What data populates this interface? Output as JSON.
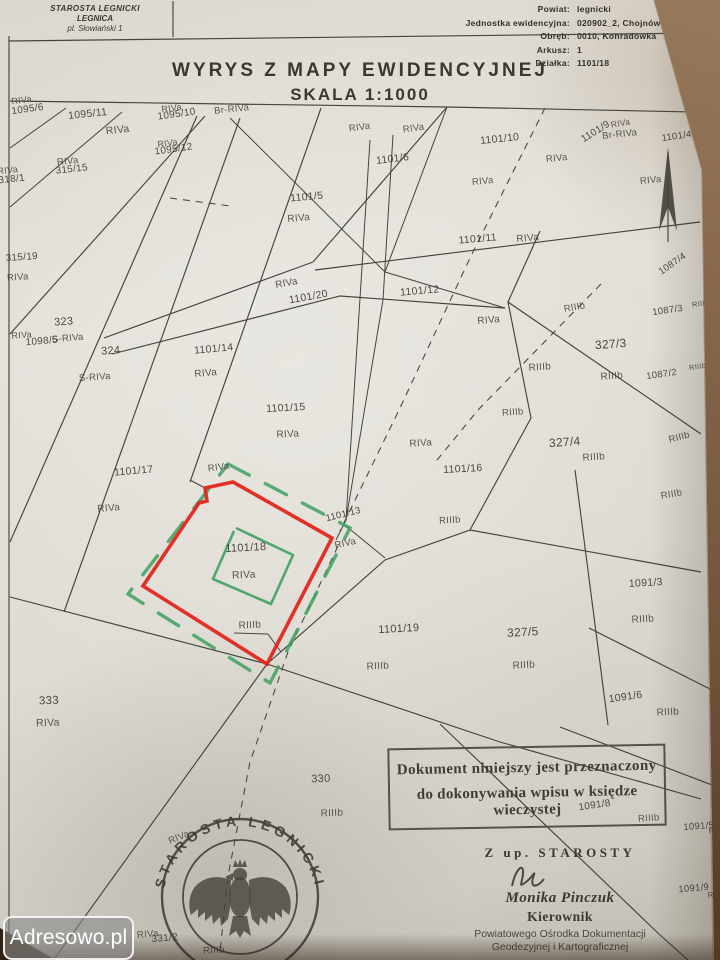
{
  "header": {
    "office_line1": "STAROSTA LEGNICKI",
    "office_line2": "LEGNICA",
    "office_line3": "pl. Słowiański 1",
    "fields": [
      {
        "label": "Powiat:",
        "value": "legnicki"
      },
      {
        "label": "Jednostka ewidencyjna:",
        "value": "020902_2, Chojnów - Gmina"
      },
      {
        "label": "Obręb:",
        "value": "0010, Konradówka"
      },
      {
        "label": "Arkusz:",
        "value": "1"
      },
      {
        "label": "Działka:",
        "value": "1101/18"
      }
    ],
    "title": "WYRYS Z MAPY EWIDENCYJNEJ",
    "scale": "SKALA 1:1000"
  },
  "map": {
    "highlight_parcel": "1101/18",
    "colors": {
      "highlight_red": "#e2261f",
      "highlight_green": "#3fa161",
      "ink": "#45433c"
    },
    "labels": [
      {
        "t": "RIVa",
        "x": 22,
        "y": 103,
        "r": -8,
        "s": 9,
        "c": "s"
      },
      {
        "t": "1095/6",
        "x": 28,
        "y": 112,
        "r": -8,
        "s": 10,
        "c": "p"
      },
      {
        "t": "1095/11",
        "x": 88,
        "y": 117,
        "r": -6,
        "s": 10.5,
        "c": "p"
      },
      {
        "t": "RIVa",
        "x": 118,
        "y": 133,
        "r": -6,
        "s": 10.5,
        "c": "s"
      },
      {
        "t": "RIVa",
        "x": 172,
        "y": 111,
        "r": -8,
        "s": 9,
        "c": "s"
      },
      {
        "t": "1095/10",
        "x": 177,
        "y": 117,
        "r": -8,
        "s": 10,
        "c": "p"
      },
      {
        "t": "Br-RIVa",
        "x": 232,
        "y": 112,
        "r": -6,
        "s": 9.5,
        "c": "s"
      },
      {
        "t": "RIVa",
        "x": 168,
        "y": 146,
        "r": -8,
        "s": 9,
        "c": "s"
      },
      {
        "t": "1095/12",
        "x": 174,
        "y": 152,
        "r": -8,
        "s": 10,
        "c": "p"
      },
      {
        "t": "RIVa",
        "x": 68,
        "y": 164,
        "r": -6,
        "s": 9.5,
        "c": "s"
      },
      {
        "t": "315/15",
        "x": 72,
        "y": 172,
        "r": -6,
        "s": 10,
        "c": "p"
      },
      {
        "t": "RIVa",
        "x": 8,
        "y": 173,
        "r": -6,
        "s": 9,
        "c": "s"
      },
      {
        "t": "318/1",
        "x": 12,
        "y": 182,
        "r": -6,
        "s": 10,
        "c": "p"
      },
      {
        "t": "315/19",
        "x": 22,
        "y": 260,
        "r": -4,
        "s": 10,
        "c": "p"
      },
      {
        "t": "RIVa",
        "x": 18,
        "y": 280,
        "r": -4,
        "s": 9.5,
        "c": "s"
      },
      {
        "t": "323",
        "x": 64,
        "y": 325,
        "r": -4,
        "s": 11,
        "c": "p"
      },
      {
        "t": "RIVa",
        "x": 22,
        "y": 338,
        "r": -5,
        "s": 9,
        "c": "s"
      },
      {
        "t": "1098/5",
        "x": 42,
        "y": 344,
        "r": -5,
        "s": 10,
        "c": "p"
      },
      {
        "t": "S-RIVa",
        "x": 68,
        "y": 341,
        "r": -5,
        "s": 9.5,
        "c": "s"
      },
      {
        "t": "324",
        "x": 111,
        "y": 354,
        "r": -4,
        "s": 11,
        "c": "p"
      },
      {
        "t": "S-RIVa",
        "x": 95,
        "y": 380,
        "r": -4,
        "s": 9.5,
        "c": "s"
      },
      {
        "t": "Br-RIVa",
        "x": 620,
        "y": 137,
        "r": -6,
        "s": 9.5,
        "c": "s"
      },
      {
        "t": "RIVa",
        "x": 360,
        "y": 130,
        "r": -8,
        "s": 9.5,
        "c": "s"
      },
      {
        "t": "RIVa",
        "x": 414,
        "y": 131,
        "r": -8,
        "s": 9.5,
        "c": "s"
      },
      {
        "t": "1101/10",
        "x": 500,
        "y": 142,
        "r": -6,
        "s": 10.5,
        "c": "p"
      },
      {
        "t": "1101/9",
        "x": 597,
        "y": 134,
        "r": -32,
        "s": 10,
        "c": "p"
      },
      {
        "t": "RIVa",
        "x": 621,
        "y": 126,
        "r": -10,
        "s": 8.5,
        "c": "s"
      },
      {
        "t": "1101/4",
        "x": 677,
        "y": 139,
        "r": -8,
        "s": 9.5,
        "c": "p"
      },
      {
        "t": "RIVa",
        "x": 699,
        "y": 127,
        "r": -8,
        "s": 8,
        "c": "s"
      },
      {
        "t": "1101/6",
        "x": 393,
        "y": 162,
        "r": -7,
        "s": 10.5,
        "c": "p"
      },
      {
        "t": "RIVa",
        "x": 557,
        "y": 161,
        "r": -6,
        "s": 9.5,
        "c": "s"
      },
      {
        "t": "RIVa",
        "x": 651,
        "y": 183,
        "r": -6,
        "s": 9.5,
        "c": "s"
      },
      {
        "t": "RIVa",
        "x": 483,
        "y": 184,
        "r": -6,
        "s": 9.5,
        "c": "s"
      },
      {
        "t": "1101/5",
        "x": 307,
        "y": 200,
        "r": -5,
        "s": 10.5,
        "c": "p"
      },
      {
        "t": "RIVa",
        "x": 299,
        "y": 221,
        "r": -5,
        "s": 10,
        "c": "s"
      },
      {
        "t": "1101/11",
        "x": 478,
        "y": 242,
        "r": -5,
        "s": 10.5,
        "c": "p"
      },
      {
        "t": "RIVa",
        "x": 528,
        "y": 241,
        "r": -5,
        "s": 10,
        "c": "s"
      },
      {
        "t": "RIVa",
        "x": 287,
        "y": 286,
        "r": -10,
        "s": 10,
        "c": "s"
      },
      {
        "t": "1101/20",
        "x": 309,
        "y": 300,
        "r": -10,
        "s": 10.5,
        "c": "p"
      },
      {
        "t": "1101/12",
        "x": 420,
        "y": 294,
        "r": -5,
        "s": 10.5,
        "c": "p"
      },
      {
        "t": "RIVa",
        "x": 489,
        "y": 323,
        "r": -5,
        "s": 10,
        "c": "s"
      },
      {
        "t": "1101/14",
        "x": 214,
        "y": 352,
        "r": -5,
        "s": 10.5,
        "c": "p"
      },
      {
        "t": "RIVa",
        "x": 206,
        "y": 376,
        "r": -5,
        "s": 10,
        "c": "s"
      },
      {
        "t": "327/3",
        "x": 611,
        "y": 348,
        "r": -4,
        "s": 12,
        "c": "p"
      },
      {
        "t": "RIIIb",
        "x": 612,
        "y": 379,
        "r": -4,
        "s": 10,
        "c": "s"
      },
      {
        "t": "RIIIb",
        "x": 540,
        "y": 370,
        "r": -4,
        "s": 10,
        "c": "s"
      },
      {
        "t": "RIIIb",
        "x": 575,
        "y": 310,
        "r": -10,
        "s": 9.5,
        "c": "s"
      },
      {
        "t": "1087/4",
        "x": 674,
        "y": 266,
        "r": -35,
        "s": 9.5,
        "c": "p"
      },
      {
        "t": "1087/3",
        "x": 668,
        "y": 313,
        "r": -8,
        "s": 9.5,
        "c": "p"
      },
      {
        "t": "RIIIb",
        "x": 701,
        "y": 306,
        "r": -8,
        "s": 7.5,
        "c": "s"
      },
      {
        "t": "1087/2",
        "x": 662,
        "y": 377,
        "r": -8,
        "s": 9.5,
        "c": "p"
      },
      {
        "t": "RIIIb",
        "x": 698,
        "y": 369,
        "r": -8,
        "s": 7.5,
        "c": "s"
      },
      {
        "t": "1101/15",
        "x": 286,
        "y": 411,
        "r": -3,
        "s": 10.5,
        "c": "p"
      },
      {
        "t": "RIVa",
        "x": 288,
        "y": 437,
        "r": -3,
        "s": 10,
        "c": "s"
      },
      {
        "t": "RIVa",
        "x": 421,
        "y": 446,
        "r": -4,
        "s": 10,
        "c": "s"
      },
      {
        "t": "RIIIb",
        "x": 513,
        "y": 415,
        "r": -4,
        "s": 9.5,
        "c": "s"
      },
      {
        "t": "327/4",
        "x": 565,
        "y": 446,
        "r": -4,
        "s": 12,
        "c": "p"
      },
      {
        "t": "RIIIb",
        "x": 594,
        "y": 460,
        "r": -4,
        "s": 10,
        "c": "s"
      },
      {
        "t": "RIIIb",
        "x": 680,
        "y": 440,
        "r": -15,
        "s": 9.5,
        "c": "s"
      },
      {
        "t": "RIIIb",
        "x": 672,
        "y": 497,
        "r": -10,
        "s": 9.5,
        "c": "s"
      },
      {
        "t": "1101/17",
        "x": 134,
        "y": 474,
        "r": -5,
        "s": 10.5,
        "c": "p"
      },
      {
        "t": "RIVa",
        "x": 109,
        "y": 511,
        "r": -5,
        "s": 10,
        "c": "s"
      },
      {
        "t": "RIVa",
        "x": 219,
        "y": 470,
        "r": -8,
        "s": 9.5,
        "c": "s"
      },
      {
        "t": "1101/13",
        "x": 344,
        "y": 517,
        "r": -14,
        "s": 9.5,
        "c": "p"
      },
      {
        "t": "RIVa",
        "x": 346,
        "y": 546,
        "r": -12,
        "s": 9.5,
        "c": "s"
      },
      {
        "t": "1101/16",
        "x": 463,
        "y": 472,
        "r": -3,
        "s": 10.5,
        "c": "p"
      },
      {
        "t": "RIIIb",
        "x": 450,
        "y": 523,
        "r": -3,
        "s": 9.5,
        "c": "s"
      },
      {
        "t": "1101/18",
        "x": 246,
        "y": 551,
        "r": -3,
        "s": 11,
        "c": "p"
      },
      {
        "t": "RIVa",
        "x": 244,
        "y": 578,
        "r": -3,
        "s": 10.5,
        "c": "s"
      },
      {
        "t": "RIIIb",
        "x": 250,
        "y": 628,
        "r": -3,
        "s": 10,
        "c": "s"
      },
      {
        "t": "1101/19",
        "x": 399,
        "y": 632,
        "r": -3,
        "s": 11,
        "c": "p"
      },
      {
        "t": "RIIIb",
        "x": 378,
        "y": 669,
        "r": -3,
        "s": 10,
        "c": "s"
      },
      {
        "t": "327/5",
        "x": 523,
        "y": 636,
        "r": -3,
        "s": 12,
        "c": "p"
      },
      {
        "t": "RIIIb",
        "x": 524,
        "y": 668,
        "r": -3,
        "s": 10,
        "c": "s"
      },
      {
        "t": "1091/3",
        "x": 646,
        "y": 586,
        "r": -3,
        "s": 10.5,
        "c": "p"
      },
      {
        "t": "RIIIb",
        "x": 643,
        "y": 622,
        "r": -3,
        "s": 10,
        "c": "s"
      },
      {
        "t": "1091/6",
        "x": 626,
        "y": 700,
        "r": -8,
        "s": 10.5,
        "c": "p"
      },
      {
        "t": "RIIIb",
        "x": 668,
        "y": 715,
        "r": -3,
        "s": 10,
        "c": "s"
      },
      {
        "t": "333",
        "x": 49,
        "y": 704,
        "r": -2,
        "s": 11.5,
        "c": "p"
      },
      {
        "t": "RIVa",
        "x": 48,
        "y": 726,
        "r": -2,
        "s": 10.5,
        "c": "s"
      },
      {
        "t": "330",
        "x": 321,
        "y": 782,
        "r": -2,
        "s": 11,
        "c": "p"
      },
      {
        "t": "RIIIb",
        "x": 332,
        "y": 816,
        "r": -2,
        "s": 10,
        "c": "s"
      },
      {
        "t": "1091/8",
        "x": 595,
        "y": 808,
        "r": -8,
        "s": 10,
        "c": "p"
      },
      {
        "t": "RIIIb",
        "x": 649,
        "y": 821,
        "r": -4,
        "s": 9.5,
        "c": "s"
      },
      {
        "t": "1091/5",
        "x": 699,
        "y": 829,
        "r": -4,
        "s": 9.5,
        "c": "p"
      },
      {
        "t": "RIIIb",
        "x": 718,
        "y": 833,
        "r": -4,
        "s": 8,
        "c": "s"
      },
      {
        "t": "1091/9",
        "x": 694,
        "y": 891,
        "r": -5,
        "s": 9.5,
        "c": "p"
      },
      {
        "t": "RIIIb",
        "x": 717,
        "y": 897,
        "r": -5,
        "s": 8,
        "c": "s"
      },
      {
        "t": "RIVa",
        "x": 180,
        "y": 840,
        "r": -22,
        "s": 9.5,
        "c": "s"
      },
      {
        "t": "RIVa",
        "x": 148,
        "y": 937,
        "r": -5,
        "s": 9.5,
        "c": "s"
      },
      {
        "t": "331/2",
        "x": 165,
        "y": 941,
        "r": -5,
        "s": 10,
        "c": "p"
      },
      {
        "t": "RIIIb",
        "x": 214,
        "y": 953,
        "r": -3,
        "s": 9.5,
        "c": "s"
      }
    ]
  },
  "stamp_box": {
    "line1": "Dokument niniejszy jest przeznaczony",
    "line2": "do dokonywania wpisu w księdze wieczystej"
  },
  "signature": {
    "on_behalf": "Z up. STAROSTY",
    "name": "Monika Pinczuk",
    "role": "Kierownik",
    "org_line1": "Powiatowego Ośrodka Dokumentacji",
    "org_line2": "Geodezyjnej i Kartograficznej"
  },
  "round_stamp": {
    "text": "STAROSTA LEGNICKI"
  },
  "photo": {
    "watermark": "Adresowo.pl"
  }
}
